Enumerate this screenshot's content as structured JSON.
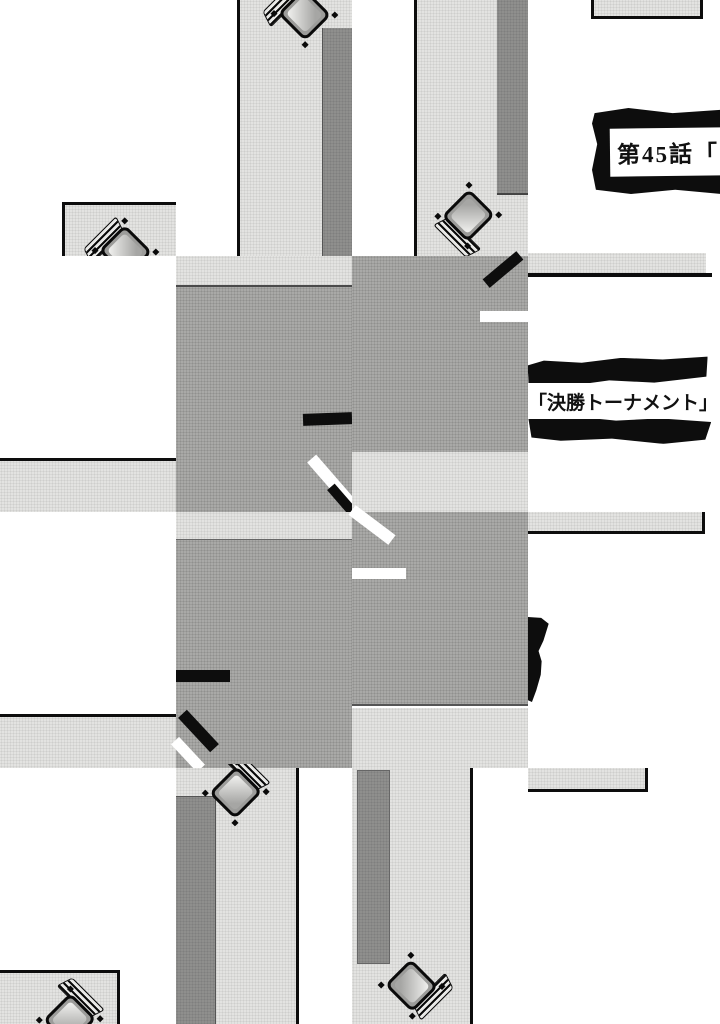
{
  "page_type": "manga-page",
  "titles": {
    "chapter": "第45話「",
    "arc": "「決勝トーナメント」"
  },
  "colors": {
    "background": "#ffffff",
    "floor_light": "#e3e3e1",
    "floor_mid": "#a9a9a7",
    "block_dark": "#8f8f8d",
    "ink": "#0d0d0d"
  },
  "icons": {
    "desk": "desk-chair-overhead-icon"
  }
}
